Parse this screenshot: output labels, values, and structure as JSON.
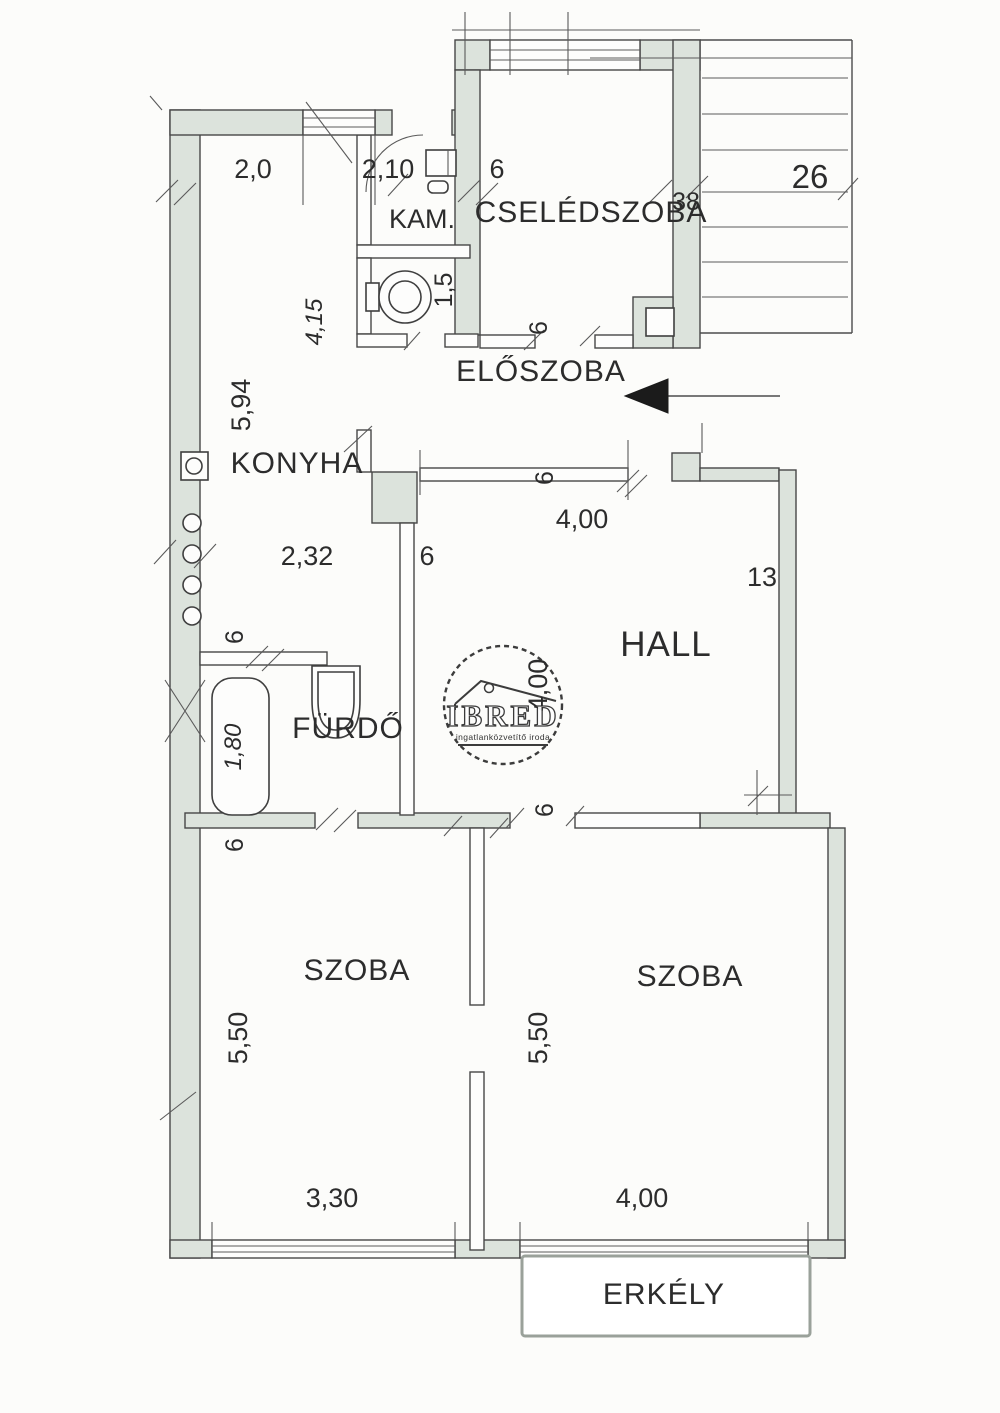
{
  "rooms": {
    "kam": "KAM.",
    "cseledszoba": "CSELÉDSZOBA",
    "eloszoba": "ELŐSZOBA",
    "konyha": "KONYHA",
    "hall": "HALL",
    "furdo": "FÜRDŐ",
    "szoba_left": "SZOBA",
    "szoba_right": "SZOBA",
    "erkely": "ERKÉLY"
  },
  "dims": {
    "d2_0": "2,0",
    "d2_10": "2,10",
    "d6_top": "6",
    "d38": "38",
    "d26": "26",
    "d1_5": "1,5",
    "d6_cseled_door": "6",
    "d4_15": "4,15",
    "d5_94": "5,94",
    "d4_00_eloszoba": "4,00",
    "d6_hall_top": "6",
    "d2_32": "2,32",
    "d6_konyha_wall": "6",
    "d13": "13",
    "d6_furdo_top": "6",
    "d1_80": "1,80",
    "d4_00_hall": "4,00",
    "d6_hall_bottom": "6",
    "d6_szoba_top": "6",
    "d5_50_left": "5,50",
    "d5_50_right": "5,50",
    "d3_30": "3,30",
    "d4_00_szoba": "4,00"
  },
  "watermark": {
    "brand": "IBRED",
    "tagline": "ingatlanközvetítő iroda"
  }
}
